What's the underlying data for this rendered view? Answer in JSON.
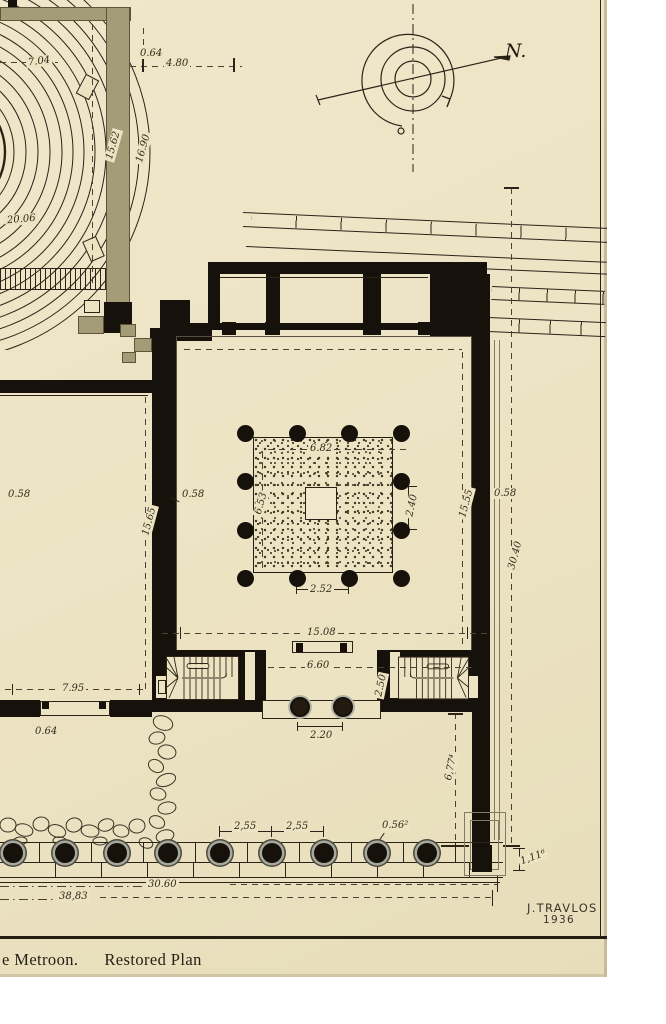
{
  "title": "Metroon restored plan drawing",
  "caption": {
    "left": "e Metroon.",
    "right": "Restored Plan"
  },
  "signature": {
    "name": "J.TRAVLOS",
    "year": "1936"
  },
  "compass": {
    "label": "N."
  },
  "labels": {
    "t704": "7.04",
    "t064": "0.64",
    "t480": "4.80",
    "t1562": "15.62",
    "t1690": "16.90",
    "t2006": "20.06",
    "l058a": "0.58",
    "l1565": "15.65",
    "c058l": "0.58",
    "p682": "6.82",
    "p653": "6.53",
    "p240": "2.40",
    "p252": "2.52",
    "c1555": "15.55",
    "c058r": "0.58",
    "m3040": "30.40",
    "s1508": "15.08",
    "s660": "6.60",
    "s250": "2.50",
    "s220": "2.20",
    "d795": "7.95",
    "d064": "0.64",
    "st255a": "2,55",
    "st255b": "2,55",
    "st056": "0.56²",
    "v677": "6,77⁴",
    "v111": "1,11⁶",
    "b3060": "30.60",
    "b3883": "38,83"
  },
  "colors": {
    "paper": "#ece3c3",
    "ink": "#17110b",
    "line": "#2b2318",
    "dash": "#4a4130",
    "olive": "#a49b77",
    "gray_ring": "#a6aa9c",
    "gray_line": "#7f7b67"
  }
}
